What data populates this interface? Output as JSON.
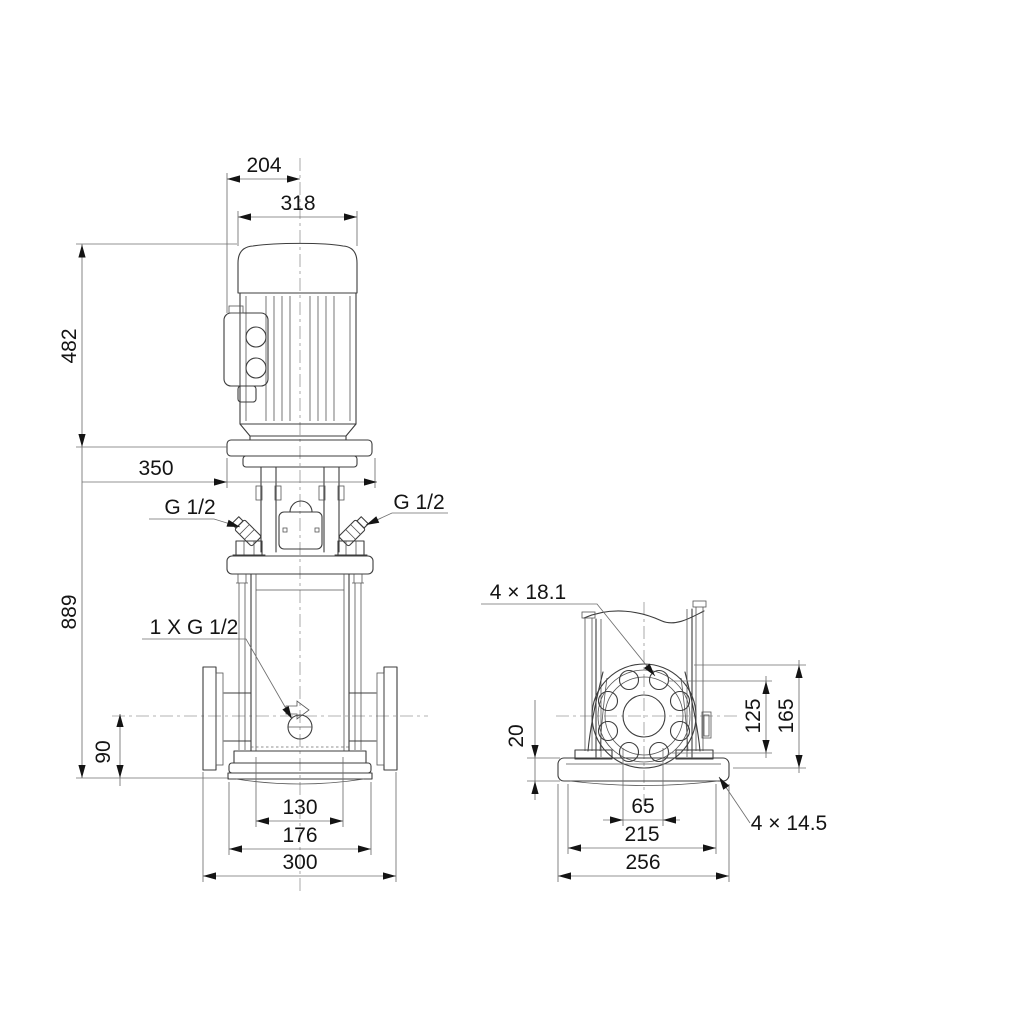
{
  "drawing": {
    "background": "#ffffff",
    "colors": {
      "object_line": "#3d3d3d",
      "dimension_line": "#6f6f6f",
      "centerline": "#9a9a9a",
      "text": "#141414"
    },
    "front_view": {
      "dim_204": "204",
      "dim_318": "318",
      "dim_482": "482",
      "dim_350": "350",
      "dim_889": "889",
      "dim_90": "90",
      "dim_130": "130",
      "dim_176": "176",
      "dim_300": "300",
      "port_left_label": "G 1/2",
      "port_right_label": "G 1/2",
      "drain_label": "1 X G 1/2"
    },
    "side_view": {
      "flange_holes_label": "4 × 18.1",
      "dim_20": "20",
      "dim_125": "125",
      "dim_165": "165",
      "dim_65": "65",
      "dim_215": "215",
      "dim_256": "256",
      "base_holes_label": "4 × 14.5"
    }
  }
}
